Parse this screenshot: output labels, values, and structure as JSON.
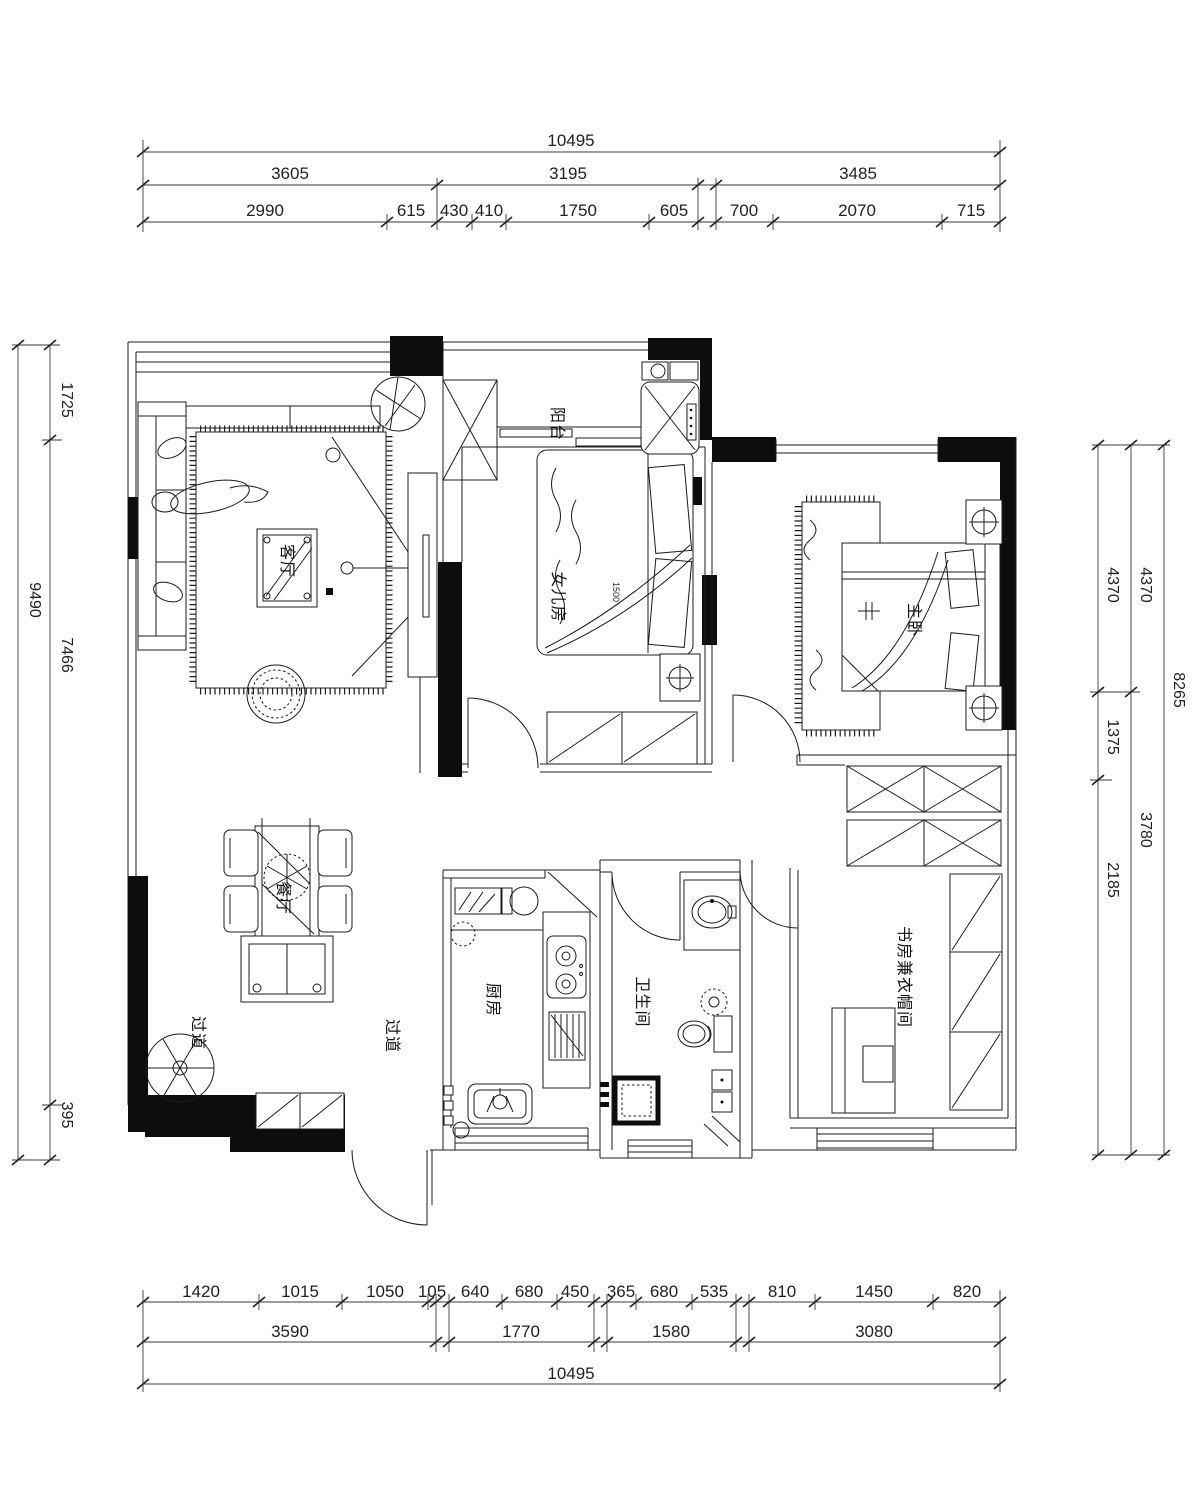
{
  "rooms": {
    "balcony": "阳台",
    "daughter": "女儿房",
    "master": "主卧",
    "living": "客厅",
    "dining": "餐厅",
    "kitchen": "厨房",
    "bath": "卫生间",
    "hall_a": "过道",
    "hall_b": "过道",
    "study": "书房兼衣帽间"
  },
  "annotations": {
    "daughter_bed_width": "1500"
  },
  "dims": {
    "top": {
      "total": "10495",
      "groups": [
        "3605",
        "3195",
        "3485"
      ],
      "detail": [
        "2990",
        "615",
        "430",
        "410",
        "1750",
        "605",
        "700",
        "2070",
        "715"
      ]
    },
    "bottom": {
      "detail": [
        "1420",
        "1015",
        "1050",
        "105",
        "640",
        "680",
        "450",
        "365",
        "680",
        "535",
        "810",
        "1450",
        "820"
      ],
      "groups": [
        "3590",
        "1770",
        "1580",
        "3080"
      ],
      "total": "10495"
    },
    "left": {
      "total": "9490",
      "detail": [
        "1725",
        "7466",
        "395"
      ]
    },
    "right": {
      "detail": [
        "4370",
        "1375",
        "2185"
      ],
      "groups": [
        "4370",
        "3780"
      ],
      "total": "8265"
    }
  },
  "colors": {
    "line": "#1c1c1c",
    "paper": "#ffffff"
  }
}
